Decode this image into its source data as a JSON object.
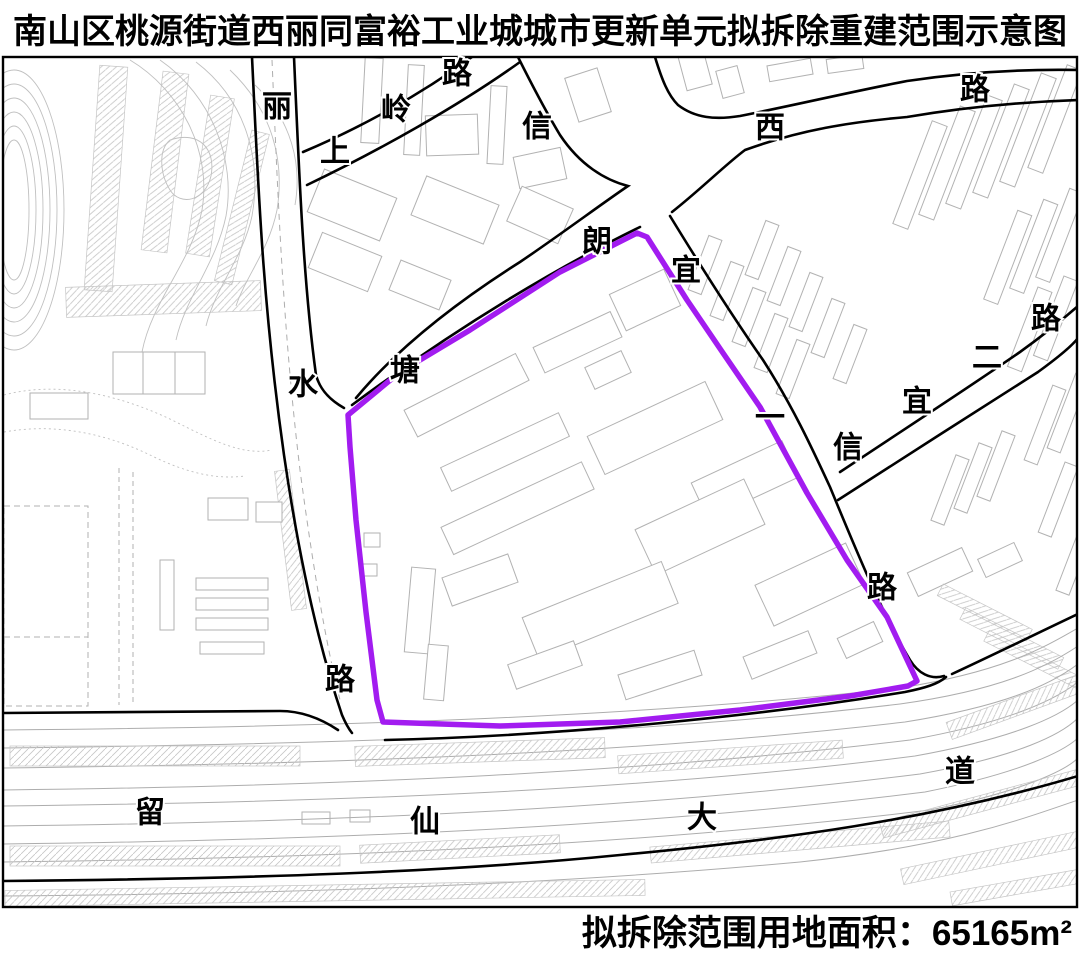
{
  "title": "南山区桃源街道西丽同富裕工业城城市更新单元拟拆除重建范围示意图",
  "map": {
    "boundary": {
      "name": "拟拆除重建范围",
      "color": "#a21cf0"
    },
    "roads": {
      "lishui": {
        "chars": [
          "丽",
          "水",
          "路"
        ]
      },
      "shangling": {
        "chars": [
          "上",
          "岭",
          "路"
        ]
      },
      "tanglang": {
        "chars": [
          "塘",
          "朗"
        ]
      },
      "xi": {
        "chars": [
          "西",
          "路"
        ]
      },
      "xinyi_yi": {
        "chars": [
          "信",
          "宜",
          "一",
          "路"
        ]
      },
      "xinyi_er": {
        "chars": [
          "信",
          "宜",
          "二",
          "路"
        ]
      },
      "liuxian": {
        "chars": [
          "留",
          "仙",
          "大",
          "道"
        ]
      }
    }
  },
  "footer": {
    "area_text": "拟拆除范围用地面积：65165m²"
  }
}
